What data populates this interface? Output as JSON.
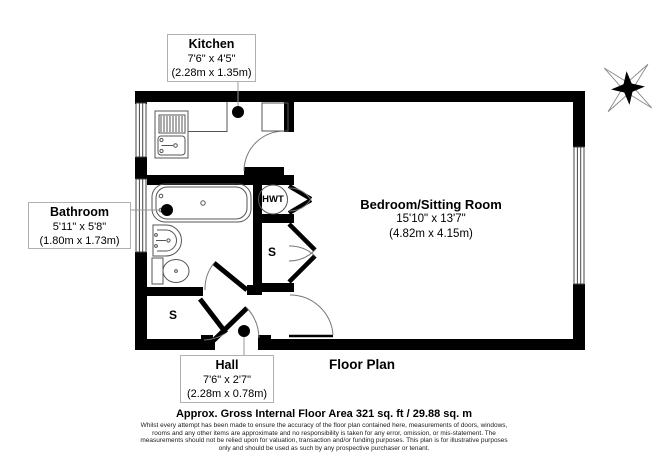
{
  "plan": {
    "title": "Floor Plan",
    "rooms": {
      "kitchen": {
        "name": "Kitchen",
        "imperial": "7'6\" x 4'5\"",
        "metric": "(2.28m x 1.35m)"
      },
      "bathroom": {
        "name": "Bathroom",
        "imperial": "5'11\" x 5'8\"",
        "metric": "(1.80m x 1.73m)"
      },
      "bedroom": {
        "name": "Bedroom/Sitting Room",
        "imperial": "15'10\" x 13'7\"",
        "metric": "(4.82m x 4.15m)"
      },
      "hall": {
        "name": "Hall",
        "imperial": "7'6\" x 2'7\"",
        "metric": "(2.28m x 0.78m)"
      }
    },
    "fixtures": {
      "hot_water_tank": "HWT",
      "storage_middle": "S",
      "storage_bottom": "S"
    }
  },
  "footer": {
    "area_line": "Approx. Gross Internal Floor Area 321 sq. ft / 29.88 sq. m",
    "disclaimer": [
      "Whilst every attempt has been made to ensure the accuracy of the floor plan contained here, measurements of doors, windows,",
      "rooms and any other items are approximate and no responsibility is taken for any error, omission, or mis-statement. The",
      "measurements should not be relied upon for valuation, transaction and/or funding purposes. This plan is for illustrative purposes",
      "only and should be used as such by any prospective purchaser or tenant."
    ]
  },
  "icons": {
    "compass": "compass-rose"
  },
  "colors": {
    "wall": "#000000",
    "fixture_line": "#555555",
    "label_border": "#b0b0b0"
  }
}
